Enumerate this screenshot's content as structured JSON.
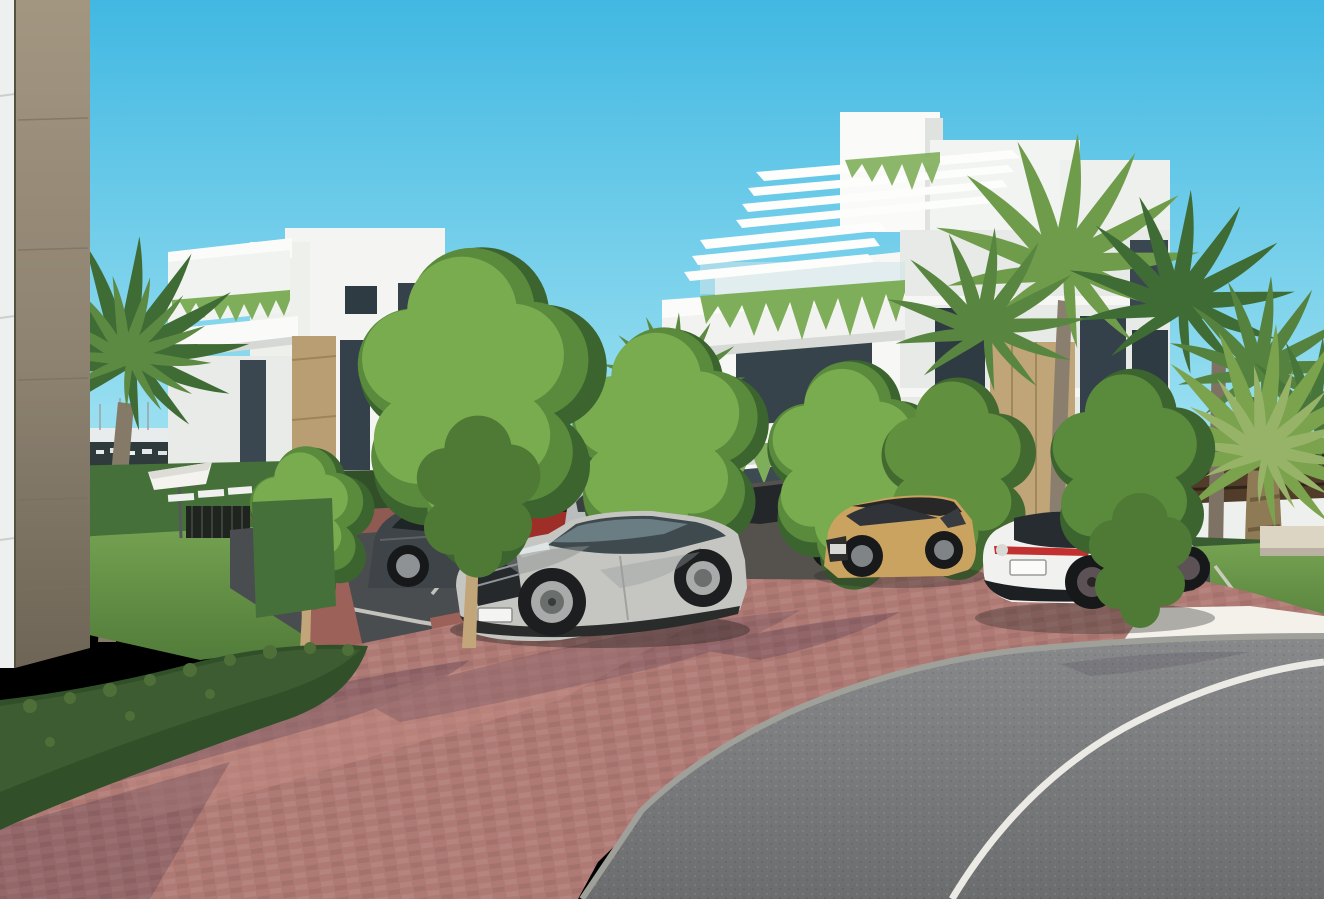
{
  "scene": {
    "setting": "sunny 3D architectural rendering of a modern white apartment complex with palm trees, parking lot and curving road",
    "palette": {
      "sky_top": "#41b8e2",
      "sky_horizon": "#a9e6f3",
      "mountain": "#b7d3df",
      "town_light": "#e9efef",
      "town_dark": "#45536a",
      "marina_dark": "#2f3a3c",
      "fence_dark": "#2e2f2d",
      "fence_brown": "#503c28",
      "wall_white": "#f6f7f4",
      "wall_shade": "#e7eae6",
      "wall_tan": "#bda277",
      "glass": "#2f3b42",
      "pergola": "#fdfdfc",
      "plant_green": "#7fae5a",
      "hedge": "#31502a",
      "hedge_light": "#46703a",
      "grass": "#67984a",
      "tree_dark": "#3c642f",
      "tree_mid": "#5a8a3c",
      "tree_light": "#79ab4f",
      "palm_dark": "#3f6b35",
      "palm_light": "#6f9c4a",
      "palm_trunk": "#8a7e6e",
      "asphalt": "#4a4d4f",
      "road": "#7c7e7f",
      "line_white": "#eceae4",
      "brick": "#b07a74",
      "brick_light": "#c08f86",
      "gravel": "#efede6",
      "curb": "#a0a09a",
      "shadow": "#3f2e49",
      "concrete": "#dcd5c4",
      "umbrella": "#f4f3ef",
      "panel_white": "#eef0ef",
      "stone_column": "#9a8d79"
    },
    "buildings": [
      {
        "name": "foreground-building-corner",
        "wall": "#eef0ef",
        "stone": "#8d8270"
      },
      {
        "name": "left-apartment-block",
        "facade": "#f4f5f2",
        "accent": "#b99e74"
      },
      {
        "name": "right-apartment-block",
        "facade": "#f7f8f5",
        "accent": "#bfa578"
      }
    ],
    "vehicles": [
      {
        "name": "parked-blue-car",
        "color": "#4a6f93"
      },
      {
        "name": "parked-dark-sedan",
        "color": "#3f4448"
      },
      {
        "name": "parked-red-car",
        "color": "#9e2f28"
      },
      {
        "name": "parked-silver-suv",
        "color": "#b9bdbe"
      },
      {
        "name": "parked-dark-gray-suv",
        "color": "#55524e"
      },
      {
        "name": "driving-silver-car",
        "color": "#c9cdcd"
      },
      {
        "name": "tan-crossover",
        "color": "#c9a35f",
        "roof": "#272727"
      },
      {
        "name": "white-luxury-sedan",
        "color": "#f1f2f0",
        "taillight": "#c23030"
      },
      {
        "name": "main-silver-suv",
        "color": "#c5c6c2"
      }
    ],
    "site_furniture": [
      "white-parasol",
      "sun-loungers",
      "metal-pool-gate",
      "concrete-benches"
    ],
    "vegetation": [
      "fan-palms",
      "date-palm",
      "green-trees",
      "boxwood-hedges",
      "lawns",
      "hanging-balcony-plants"
    ]
  }
}
